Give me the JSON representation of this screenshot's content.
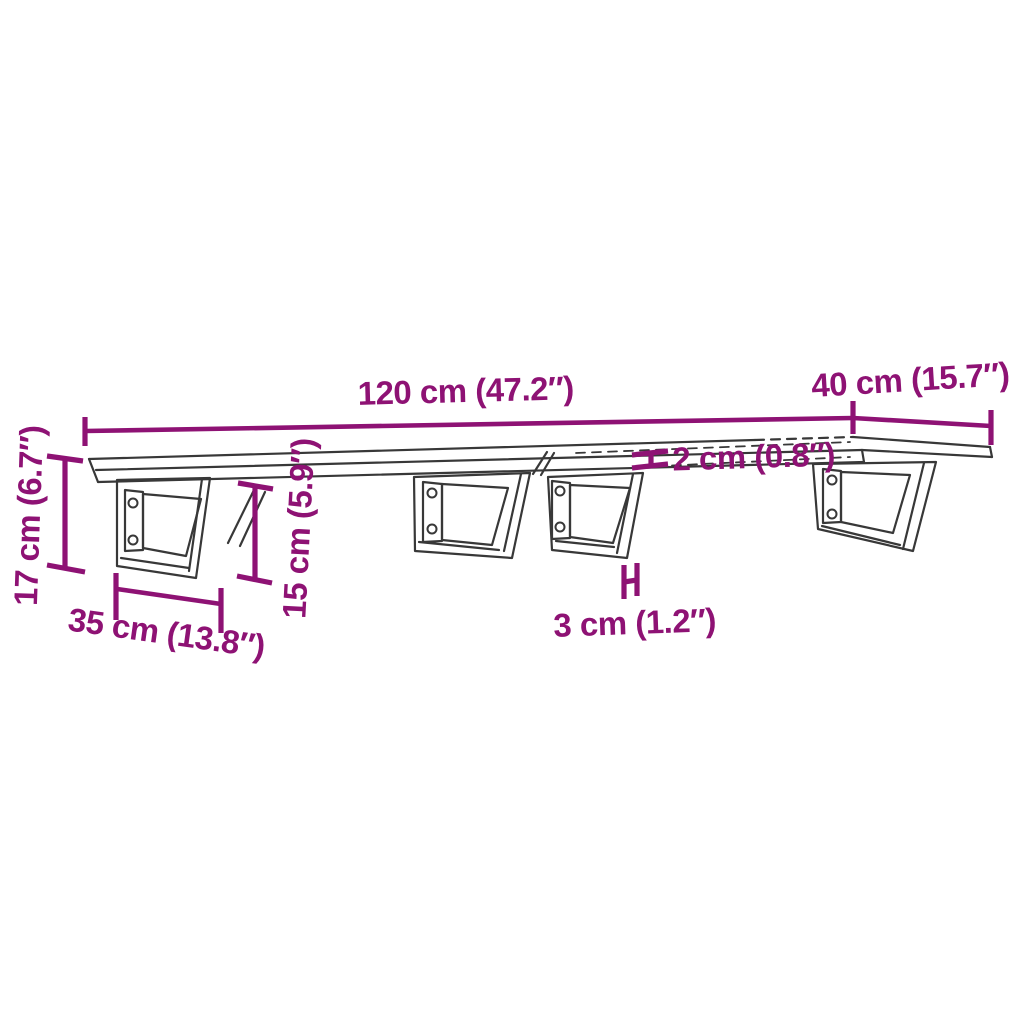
{
  "diagram": {
    "type": "product-dimension-diagram",
    "background_color": "#ffffff",
    "dimension_color": "#8E1274",
    "drawing_color": "#383838",
    "labels": {
      "length": "120 cm (47.2″)",
      "depth": "40 cm (15.7″)",
      "thickness": "2 cm (0.8″)",
      "bracket_bar_width": "3 cm (1.2″)",
      "bracket_depth": "35 cm (13.8″)",
      "total_height": "17 cm (6.7″)",
      "bracket_height": "15 cm (5.9″)"
    }
  }
}
